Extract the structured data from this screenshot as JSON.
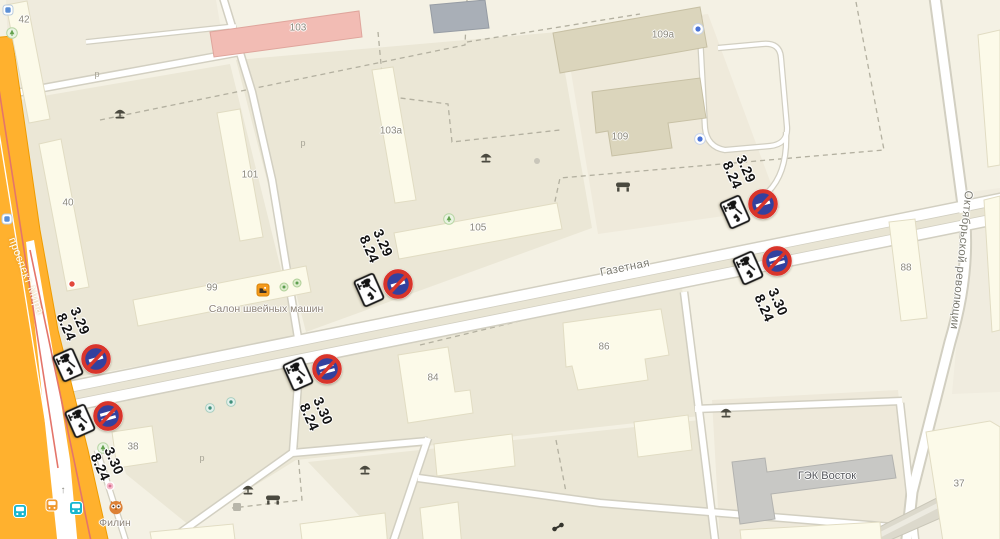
{
  "streets": [
    {
      "id": "gazetnaya",
      "label": "Газетная",
      "x": 625,
      "y": 268,
      "rot": -11.5,
      "style": "gray"
    },
    {
      "id": "oktyabrskoy-revolyutsii",
      "label": "Октябрьской революции",
      "x": 961,
      "y": 260,
      "rot": 96,
      "style": "gray"
    },
    {
      "id": "prospekt-mira",
      "label": "проспект Мира",
      "x": 26,
      "y": 276,
      "rot": 69,
      "style": "white"
    }
  ],
  "building_numbers": [
    {
      "label": "42",
      "x": 24,
      "y": 20
    },
    {
      "label": "40",
      "x": 68,
      "y": 203
    },
    {
      "label": "103",
      "x": 298,
      "y": 28
    },
    {
      "label": "101",
      "x": 250,
      "y": 175
    },
    {
      "label": "103а",
      "x": 391,
      "y": 131
    },
    {
      "label": "105",
      "x": 478,
      "y": 228
    },
    {
      "label": "99",
      "x": 212,
      "y": 288
    },
    {
      "label": "109а",
      "x": 663,
      "y": 35
    },
    {
      "label": "109",
      "x": 620,
      "y": 137
    },
    {
      "label": "88",
      "x": 906,
      "y": 268
    },
    {
      "label": "84",
      "x": 433,
      "y": 378
    },
    {
      "label": "86",
      "x": 604,
      "y": 347
    },
    {
      "label": "37",
      "x": 959,
      "y": 484
    },
    {
      "label": "38",
      "x": 133,
      "y": 447
    }
  ],
  "poi_labels": [
    {
      "label": "Салон швейных машин",
      "x": 266,
      "y": 309,
      "style": "poi"
    },
    {
      "label": "ГЭК Восток",
      "x": 827,
      "y": 476,
      "style": "dark"
    },
    {
      "label": "Филин",
      "x": 115,
      "y": 523,
      "style": "poi"
    }
  ],
  "parking_marks": [
    {
      "label": "р",
      "x": 97,
      "y": 74
    },
    {
      "label": "р",
      "x": 303,
      "y": 143
    },
    {
      "label": "р",
      "x": 202,
      "y": 458
    }
  ],
  "signs": [
    {
      "code": "3.29",
      "plate_code": "8.24",
      "bars": 1,
      "rot": 66,
      "circle": {
        "x": 763,
        "y": 204
      },
      "plate": {
        "x": 735,
        "y": 212
      },
      "label": {
        "x": 739,
        "y": 172
      }
    },
    {
      "code": "3.30",
      "plate_code": "8.24",
      "bars": 2,
      "rot": 66,
      "circle": {
        "x": 777,
        "y": 261
      },
      "plate": {
        "x": 748,
        "y": 268
      },
      "label": {
        "x": 771,
        "y": 305
      }
    },
    {
      "code": "3.29",
      "plate_code": "8.24",
      "bars": 1,
      "rot": 66,
      "circle": {
        "x": 398,
        "y": 284
      },
      "plate": {
        "x": 369,
        "y": 290
      },
      "label": {
        "x": 376,
        "y": 246
      }
    },
    {
      "code": "3.29",
      "plate_code": "8.24",
      "bars": 1,
      "rot": 66,
      "circle": {
        "x": 96,
        "y": 359
      },
      "plate": {
        "x": 68,
        "y": 365
      },
      "label": {
        "x": 73,
        "y": 324
      }
    },
    {
      "code": "3.30",
      "plate_code": "8.24",
      "bars": 2,
      "rot": 66,
      "circle": {
        "x": 327,
        "y": 369
      },
      "plate": {
        "x": 298,
        "y": 374
      },
      "label": {
        "x": 316,
        "y": 414
      }
    },
    {
      "code": "3.30",
      "plate_code": "8.24",
      "bars": 2,
      "rot": 66,
      "circle": {
        "x": 108,
        "y": 416
      },
      "plate": {
        "x": 80,
        "y": 421
      },
      "label": {
        "x": 107,
        "y": 464
      }
    }
  ],
  "sign_colors": {
    "blue": "#33419e",
    "red": "#d8352b",
    "plate_border": "#1a1a1a"
  },
  "map_colors": {
    "background": "#f4f1e4",
    "quarter": "#ebe7d6",
    "building": "#fcfae9",
    "building_dark": "#dbd5bc",
    "pink_building": "#f2bcb4",
    "gray_building": "#c8c8c5",
    "road_orange": "#ffb12e",
    "road_white": "#ffffff"
  },
  "icons": [
    {
      "type": "tree-icon",
      "x": 120,
      "y": 114
    },
    {
      "type": "tree-icon",
      "x": 486,
      "y": 158
    },
    {
      "type": "tree-icon",
      "x": 726,
      "y": 413
    },
    {
      "type": "tree-icon",
      "x": 248,
      "y": 490
    },
    {
      "type": "tree-icon",
      "x": 365,
      "y": 470
    },
    {
      "type": "bench-icon",
      "x": 623,
      "y": 187
    },
    {
      "type": "bench-icon",
      "x": 273,
      "y": 500
    },
    {
      "type": "green-poi-icon",
      "x": 12,
      "y": 33
    },
    {
      "type": "green-poi-icon",
      "x": 449,
      "y": 219
    },
    {
      "type": "green-poi-icon",
      "x": 103,
      "y": 448
    },
    {
      "type": "teal-poi-icon",
      "x": 210,
      "y": 408
    },
    {
      "type": "teal-poi-icon",
      "x": 231,
      "y": 402
    },
    {
      "type": "mini-green-icon",
      "x": 284,
      "y": 287
    },
    {
      "type": "mini-green-icon",
      "x": 297,
      "y": 283
    },
    {
      "type": "service-icon",
      "x": 698,
      "y": 29
    },
    {
      "type": "service-icon",
      "x": 700,
      "y": 139
    },
    {
      "type": "transit-icon",
      "x": 7,
      "y": 219
    },
    {
      "type": "transit-icon",
      "x": 8,
      "y": 10
    },
    {
      "type": "red-poi-icon",
      "x": 72,
      "y": 284
    },
    {
      "type": "pink-poi-icon",
      "x": 110,
      "y": 486
    },
    {
      "type": "owl-icon",
      "x": 116,
      "y": 507
    },
    {
      "type": "gray-square-icon",
      "x": 237,
      "y": 507
    },
    {
      "type": "gray-dot-icon",
      "x": 537,
      "y": 161
    },
    {
      "type": "fitness-icon",
      "x": 558,
      "y": 527
    },
    {
      "type": "sewing-shop-icon",
      "x": 263,
      "y": 290
    },
    {
      "type": "bus-icon",
      "x": 20,
      "y": 511
    },
    {
      "type": "bus-icon",
      "x": 76,
      "y": 508
    },
    {
      "type": "trolleybus-icon",
      "x": 52,
      "y": 505
    },
    {
      "type": "arrow-up-icon",
      "x": 63,
      "y": 491,
      "glyph": "↑"
    }
  ]
}
